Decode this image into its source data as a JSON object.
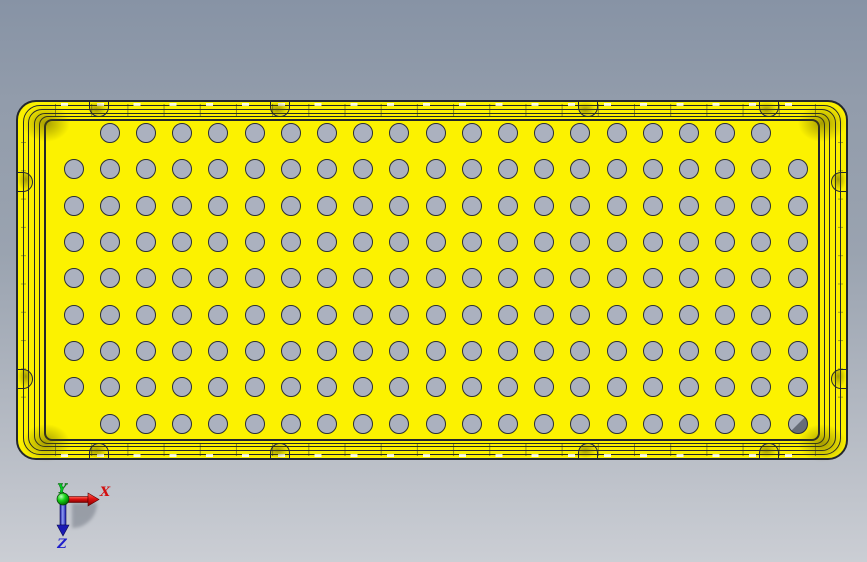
{
  "scene": {
    "background": {
      "top_color": "#8793A5",
      "bottom_color": "#CBCED4"
    }
  },
  "part": {
    "body_color": "#FBF000",
    "edge_color": "#23272C",
    "hole_color": "#ABB1BF",
    "keyed_hole_dark_color": "#666C78",
    "hole_grid": {
      "rows": 9,
      "cols": 21,
      "origin_x": 55.5,
      "origin_y": 31,
      "pitch_x": 36.2,
      "pitch_y": 36.35,
      "diameter": 20,
      "omitted": [
        [
          0,
          0
        ],
        [
          0,
          20
        ],
        [
          8,
          0
        ]
      ],
      "keyed": [
        8,
        20
      ]
    },
    "notches": {
      "top_x": [
        81,
        262,
        570,
        751
      ],
      "bottom_x": [
        81,
        262,
        570,
        751
      ],
      "left_y": [
        80,
        277
      ],
      "right_y": [
        80,
        277
      ]
    },
    "corner_smudges": [
      [
        4,
        2
      ],
      [
        780,
        2
      ],
      [
        4,
        322
      ],
      [
        780,
        322
      ]
    ]
  },
  "triad": {
    "labels": {
      "x": "X",
      "y": "Y",
      "z": "Z"
    },
    "colors": {
      "x": "#D31010",
      "y": "#00C822",
      "z": "#2020CC"
    }
  }
}
